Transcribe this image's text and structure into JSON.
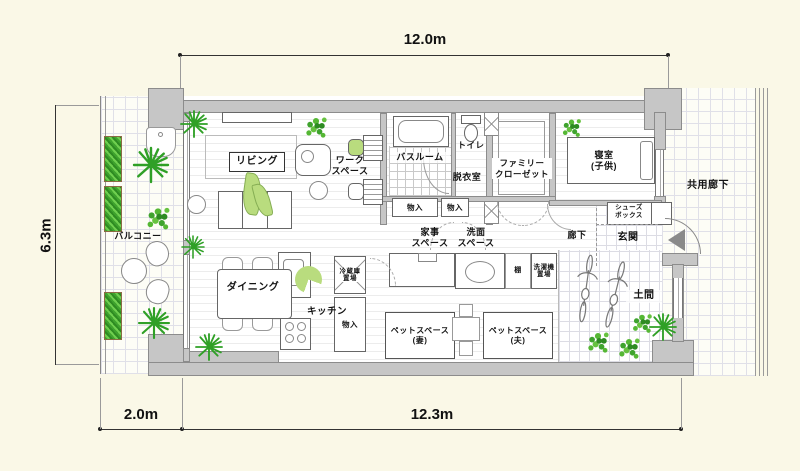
{
  "title": "apartment-floor-plan",
  "dimensions": {
    "top_width": "12.0m",
    "left_height": "6.3m",
    "bottom_balcony": "2.0m",
    "bottom_main": "12.3m"
  },
  "rooms": {
    "balcony": "バルコニー",
    "living": "リビング",
    "workspace": "ワーク\nスペース",
    "bathroom": "バスルーム",
    "toilet": "トイレ",
    "dressing_room": "脱衣室",
    "family_closet": "ファミリー\nクローゼット",
    "bedroom_child": "寝室\n(子供)",
    "shared_corridor": "共用廊下",
    "shoe_box": "シューズ\nボックス",
    "entrance": "玄関",
    "corridor": "廊下",
    "housework_space": "家事\nスペース",
    "washstand_space": "洗面\nスペース",
    "shelf": "棚",
    "washer_place": "洗濯機\n置場",
    "fridge_place": "冷蔵庫\n置場",
    "storage": "物入",
    "dining": "ダイニング",
    "kitchen": "キッチン",
    "pet_space_wife": "ペットスペース\n(妻)",
    "pet_space_husband": "ペットスペース\n(夫)",
    "doma": "土間"
  },
  "colors": {
    "background": "#faf8e7",
    "wall": "#c6c6c6",
    "wall_outline": "#8c8c8c",
    "floor": "#ffffff",
    "plant_green": "#3fa32e",
    "person_green": "#b9dc7e",
    "arrow_grey": "#8a8a8a"
  }
}
